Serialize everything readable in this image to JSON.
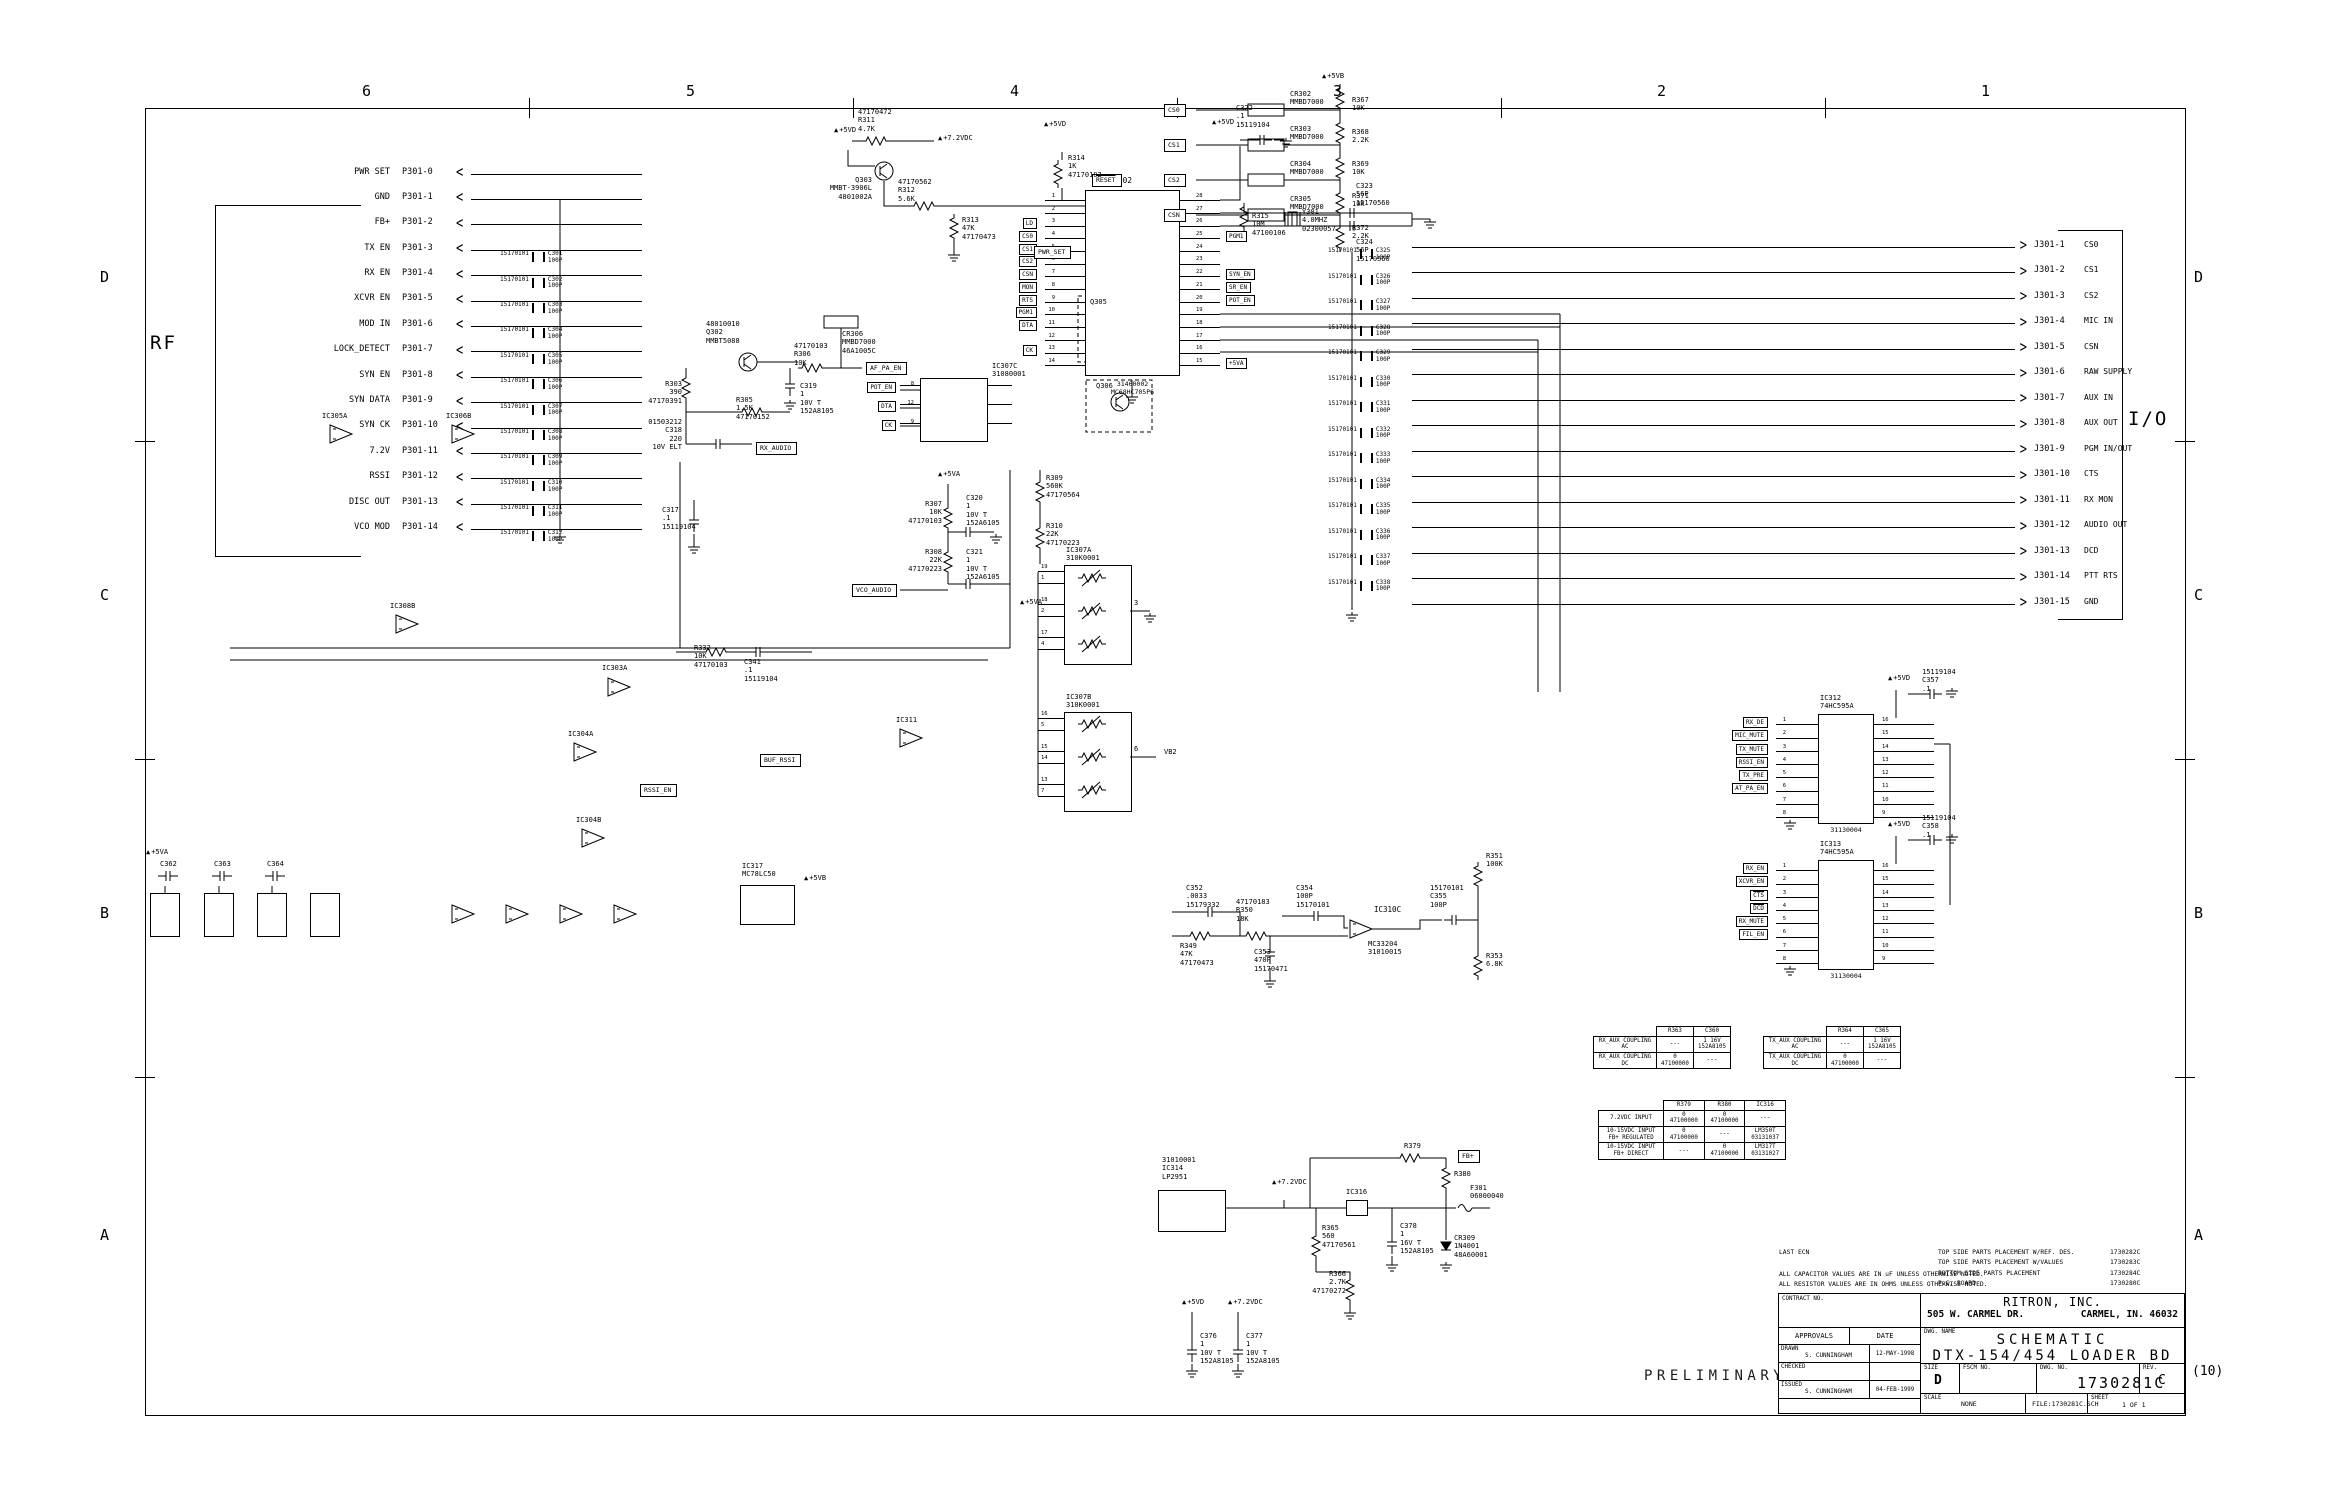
{
  "frame": {
    "cols": [
      "6",
      "5",
      "4",
      "3",
      "2",
      "1"
    ],
    "rows": [
      "D",
      "C",
      "B",
      "A"
    ],
    "rev_suffix": "(10)"
  },
  "sections": {
    "rf": "RF",
    "io": "I/O",
    "preliminary": "PRELIMINARY"
  },
  "rf": {
    "pins": [
      {
        "signal": "PWR SET",
        "pin": "P301-0",
        "cap": "",
        "cap_pn": "",
        "cap_txt": ""
      },
      {
        "signal": "GND",
        "pin": "P301-1",
        "cap": "",
        "cap_pn": "",
        "cap_txt": ""
      },
      {
        "signal": "FB+",
        "pin": "P301-2",
        "cap": "",
        "cap_pn": "",
        "cap_txt": ""
      },
      {
        "signal": "TX EN",
        "pin": "P301-3",
        "cap": "C301",
        "cap_pn": "15170101",
        "cap_txt": "C301\n100P"
      },
      {
        "signal": "RX EN",
        "pin": "P301-4",
        "cap": "C302",
        "cap_pn": "15170101",
        "cap_txt": "C302\n100P"
      },
      {
        "signal": "XCVR EN",
        "pin": "P301-5",
        "cap": "C303",
        "cap_pn": "15170101",
        "cap_txt": "C303\n100P"
      },
      {
        "signal": "MOD IN",
        "pin": "P301-6",
        "cap": "C304",
        "cap_pn": "15170101",
        "cap_txt": "C304\n100P"
      },
      {
        "signal": "LOCK_DETECT",
        "pin": "P301-7",
        "cap": "C305",
        "cap_pn": "15170101",
        "cap_txt": "C305\n100P"
      },
      {
        "signal": "SYN EN",
        "pin": "P301-8",
        "cap": "C306",
        "cap_pn": "15170101",
        "cap_txt": "C306\n100P"
      },
      {
        "signal": "SYN DATA",
        "pin": "P301-9",
        "cap": "C307",
        "cap_pn": "15170101",
        "cap_txt": "C307\n100P"
      },
      {
        "signal": "SYN CK",
        "pin": "P301-10",
        "cap": "C308",
        "cap_pn": "15170101",
        "cap_txt": "C308\n100P"
      },
      {
        "signal": "7.2V",
        "pin": "P301-11",
        "cap": "C309",
        "cap_pn": "15170101",
        "cap_txt": "C309\n100P"
      },
      {
        "signal": "RSSI",
        "pin": "P301-12",
        "cap": "C310",
        "cap_pn": "15170101",
        "cap_txt": "C310\n100P"
      },
      {
        "signal": "DISC OUT",
        "pin": "P301-13",
        "cap": "C311",
        "cap_pn": "15170101",
        "cap_txt": "C311\n100P"
      },
      {
        "signal": "VCO MOD",
        "pin": "P301-14",
        "cap": "C312",
        "cap_pn": "15170101",
        "cap_txt": "C312\n100P"
      }
    ]
  },
  "io": {
    "pins": [
      {
        "pin": "J301-1",
        "signal": "CS0",
        "cap": "C325",
        "cap_pn": "15170101",
        "cap_txt": "C325\n100P"
      },
      {
        "pin": "J301-2",
        "signal": "CS1",
        "cap": "C326",
        "cap_pn": "15170101",
        "cap_txt": "C326\n100P"
      },
      {
        "pin": "J301-3",
        "signal": "CS2",
        "cap": "C327",
        "cap_pn": "15170101",
        "cap_txt": "C327\n100P"
      },
      {
        "pin": "J301-4",
        "signal": "MIC IN",
        "cap": "C328",
        "cap_pn": "15170101",
        "cap_txt": "C328\n100P"
      },
      {
        "pin": "J301-5",
        "signal": "CSN",
        "cap": "C329",
        "cap_pn": "15170101",
        "cap_txt": "C329\n100P"
      },
      {
        "pin": "J301-6",
        "signal": "RAW SUPPLY",
        "cap": "C330",
        "cap_pn": "15170101",
        "cap_txt": "C330\n100P"
      },
      {
        "pin": "J301-7",
        "signal": "AUX IN",
        "cap": "C331",
        "cap_pn": "15170101",
        "cap_txt": "C331\n100P"
      },
      {
        "pin": "J301-8",
        "signal": "AUX OUT",
        "cap": "C332",
        "cap_pn": "15170101",
        "cap_txt": "C332\n100P"
      },
      {
        "pin": "J301-9",
        "signal": "PGM IN/OUT",
        "cap": "C333",
        "cap_pn": "15170101",
        "cap_txt": "C333\n100P"
      },
      {
        "pin": "J301-10",
        "signal": "CTS",
        "cap": "C334",
        "cap_pn": "15170101",
        "cap_txt": "C334\n100P"
      },
      {
        "pin": "J301-11",
        "signal": "RX MON",
        "cap": "C335",
        "cap_pn": "15170101",
        "cap_txt": "C335\n100P"
      },
      {
        "pin": "J301-12",
        "signal": "AUDIO OUT",
        "cap": "C336",
        "cap_pn": "15170101",
        "cap_txt": "C336\n100P"
      },
      {
        "pin": "J301-13",
        "signal": "DCD",
        "cap": "C337",
        "cap_pn": "15170101",
        "cap_txt": "C337\n100P"
      },
      {
        "pin": "J301-14",
        "signal": "PTT RTS",
        "cap": "C338",
        "cap_pn": "15170101",
        "cap_txt": "C338\n100P"
      },
      {
        "pin": "J301-15",
        "signal": "GND",
        "cap": "",
        "cap_pn": "",
        "cap_txt": ""
      }
    ]
  },
  "mcu": {
    "ref": "IC302",
    "pn": "31460002\nMC68HC705P6",
    "left": [
      {
        "n": "1",
        "name": "RESET",
        "flag": ""
      },
      {
        "n": "2",
        "name": "IRQ",
        "flag": ""
      },
      {
        "n": "3",
        "name": "PA7",
        "flag": "LD"
      },
      {
        "n": "4",
        "name": "PA6",
        "flag": "CS0"
      },
      {
        "n": "5",
        "name": "PA5",
        "flag": "CS1"
      },
      {
        "n": "6",
        "name": "PA4",
        "flag": "CS2"
      },
      {
        "n": "7",
        "name": "PA3",
        "flag": "CSN"
      },
      {
        "n": "8",
        "name": "PA2",
        "flag": "MON"
      },
      {
        "n": "9",
        "name": "PA1",
        "flag": "RTS"
      },
      {
        "n": "10",
        "name": "PA0",
        "flag": "PGM1"
      },
      {
        "n": "11",
        "name": "PB5/SDO",
        "flag": "DTA"
      },
      {
        "n": "12",
        "name": "PB6/SDI",
        "flag": ""
      },
      {
        "n": "13",
        "name": "PB7/SCK",
        "flag": "CK"
      },
      {
        "n": "14",
        "name": "VSS",
        "flag": ""
      }
    ],
    "right": [
      {
        "n": "28",
        "name": "VDD",
        "flag": ""
      },
      {
        "n": "27",
        "name": "OSC1",
        "flag": ""
      },
      {
        "n": "26",
        "name": "OSC2",
        "flag": ""
      },
      {
        "n": "25",
        "name": "PD7/TCAP",
        "flag": "PGM1"
      },
      {
        "n": "24",
        "name": "TCMP",
        "flag": ""
      },
      {
        "n": "23",
        "name": "PD5",
        "flag": ""
      },
      {
        "n": "22",
        "name": "PC0",
        "flag": "SYN_EN"
      },
      {
        "n": "21",
        "name": "PC1",
        "flag": "SR_EN"
      },
      {
        "n": "20",
        "name": "PC2",
        "flag": "POT_EN"
      },
      {
        "n": "19",
        "name": "PC3/AN3",
        "flag": ""
      },
      {
        "n": "18",
        "name": "PC4/AN2",
        "flag": ""
      },
      {
        "n": "17",
        "name": "PC5/AN1",
        "flag": ""
      },
      {
        "n": "16",
        "name": "PC6/AN0",
        "flag": ""
      },
      {
        "n": "15",
        "name": "PC7/VRH",
        "flag": "+5VA"
      }
    ]
  },
  "pots": {
    "a_ref": "IC307A\n310K0001",
    "b_ref": "IC307B\n310K0001",
    "a_rows": [
      {
        "n1": "19",
        "n2": "1",
        "label": "BALANCE"
      },
      {
        "n1": "18",
        "n2": "2",
        "label": "TX FREQ"
      },
      {
        "n1": "17",
        "n2": "4",
        "label": "RX AUDIO GAIN"
      }
    ],
    "b_rows": [
      {
        "n1": "16",
        "n2": "5",
        "label": "AUX RX GAIN"
      },
      {
        "n1": "15",
        "n2": "14",
        "label": "AUX TX GAIN"
      },
      {
        "n1": "13",
        "n2": "7",
        "label": "DEVIATION"
      }
    ],
    "a_com": "3",
    "b_com": "6",
    "b_net": "VB2",
    "c_ref": "IC307C\n31080001",
    "c_left": [
      {
        "n": "8",
        "name": "RST",
        "flag": "POT_EN"
      },
      {
        "n": "12",
        "name": "DATA IN",
        "flag": "DTA"
      },
      {
        "n": "9",
        "name": "CLK",
        "flag": "CK"
      }
    ],
    "c_right": [
      {
        "name": "VCC"
      },
      {
        "name": "D OUT"
      },
      {
        "name": "GND"
      }
    ]
  },
  "sr1": {
    "ref": "IC312\n74HC595A",
    "pn": "31130004",
    "cap": "15119104\nC357\n.1",
    "left": [
      {
        "n": "1",
        "name": "QB",
        "flag": "RX_DE"
      },
      {
        "n": "2",
        "name": "QC",
        "flag": "MIC_MUTE"
      },
      {
        "n": "3",
        "name": "QD",
        "flag": "TX_MUTE"
      },
      {
        "n": "4",
        "name": "QE",
        "flag": "RSSI_EN"
      },
      {
        "n": "5",
        "name": "QF",
        "flag": "TX_PRE"
      },
      {
        "n": "6",
        "name": "QG",
        "flag": "AT_PA_EN"
      },
      {
        "n": "7",
        "name": "QH",
        "flag": ""
      },
      {
        "n": "8",
        "name": "GND",
        "flag": ""
      }
    ],
    "right": [
      {
        "n": "16",
        "name": "VCC"
      },
      {
        "n": "15",
        "name": "QA"
      },
      {
        "n": "14",
        "name": "A"
      },
      {
        "n": "13",
        "name": "OE"
      },
      {
        "n": "12",
        "name": "LC"
      },
      {
        "n": "11",
        "name": "SC"
      },
      {
        "n": "10",
        "name": "RST"
      },
      {
        "n": "9",
        "name": "SQH"
      }
    ]
  },
  "sr2": {
    "ref": "IC313\n74HC595A",
    "pn": "31130004",
    "cap": "15119104\nC358\n.1",
    "left": [
      {
        "n": "1",
        "name": "QB",
        "flag": "RX_EN"
      },
      {
        "n": "2",
        "name": "QC",
        "flag": "XCVR_EN"
      },
      {
        "n": "3",
        "name": "QD",
        "flag": "CTS"
      },
      {
        "n": "4",
        "name": "QE",
        "flag": "DCD"
      },
      {
        "n": "5",
        "name": "QF",
        "flag": "RX_MUTE"
      },
      {
        "n": "6",
        "name": "QG",
        "flag": "FIL_EN"
      },
      {
        "n": "7",
        "name": "QH",
        "flag": ""
      },
      {
        "n": "8",
        "name": "GND",
        "flag": ""
      }
    ],
    "right": [
      {
        "n": "16",
        "name": "VCC"
      },
      {
        "n": "15",
        "name": "QA"
      },
      {
        "n": "14",
        "name": "A"
      },
      {
        "n": "13",
        "name": "OE"
      },
      {
        "n": "12",
        "name": "LC"
      },
      {
        "n": "11",
        "name": "SC"
      },
      {
        "n": "10",
        "name": "RST"
      },
      {
        "n": "9",
        "name": "SQH"
      }
    ]
  },
  "tables": {
    "t1": {
      "h": [
        "R363",
        "C360"
      ],
      "rows": [
        [
          "RX_AUX COUPLING\nAC",
          "---",
          "1 16V\n152A8105"
        ],
        [
          "RX_AUX COUPLING\nDC",
          "0\n47100000",
          "---"
        ]
      ]
    },
    "t2": {
      "h": [
        "R364",
        "C365"
      ],
      "rows": [
        [
          "TX_AUX COUPLING\nAC",
          "---",
          "1 16V\n152A8105"
        ],
        [
          "TX_AUX COUPLING\nDC",
          "0\n47100000",
          "---"
        ]
      ]
    },
    "t3": {
      "h": [
        "R379",
        "R380",
        "IC316"
      ],
      "rows": [
        [
          "7.2VDC INPUT",
          "0\n47100000",
          "0\n47100000",
          "---"
        ],
        [
          "10-15VDC INPUT\nFB+ REGULATED",
          "0\n47100000",
          "---",
          "LM350T\n03131037"
        ],
        [
          "10-15VDC INPUT\nFB+ DIRECT",
          "---",
          "0\n47100000",
          "LM317T\n03131027"
        ]
      ]
    }
  },
  "notes": {
    "last_ecn": "LAST ECN",
    "cap_note": "ALL CAPACITOR VALUES ARE IN uF UNLESS OTHERWISE NOTED.",
    "res_note": "ALL RESISTOR VALUES ARE IN OHMS UNLESS OTHERWISE NOTED.",
    "refs": [
      {
        "label": "TOP SIDE PARTS PLACEMENT W/REF. DES.",
        "num": "1730282C"
      },
      {
        "label": "TOP SIDE PARTS PLACEMENT W/VALUES",
        "num": "1730283C"
      },
      {
        "label": "BOTTOM SIDE PARTS PLACEMENT",
        "num": "1730284C"
      },
      {
        "label": "P.C. BOARD",
        "num": "1730280C"
      }
    ]
  },
  "title": {
    "contract_label": "CONTRACT NO.",
    "approvals": "APPROVALS",
    "date": "DATE",
    "drawn_label": "DRAWN",
    "drawn_by": "S. CUNNINGHAM",
    "drawn_date": "12-MAY-1998",
    "checked_label": "CHECKED",
    "issued_label": "ISSUED",
    "issued_by": "S. CUNNINGHAM",
    "issued_date": "04-FEB-1999",
    "company": "RITRON, INC.",
    "addr1": "505 W. CARMEL DR.",
    "addr2": "CARMEL, IN. 46032",
    "dwg_name_label": "DWG. NAME",
    "name1": "SCHEMATIC",
    "name2": "DTX-154/454 LOADER BD",
    "size_label": "SIZE",
    "size": "D",
    "fscm_label": "FSCM NO.",
    "dwgno_label": "DWG. NO.",
    "dwgno": "1730281C",
    "rev_label": "REV.",
    "rev": "C",
    "scale_label": "SCALE",
    "scale": "NONE",
    "file": "FILE:1730281C.SCH",
    "sheet_label": "SHEET",
    "sheet": "1  OF  1"
  },
  "misc": [
    "+5VD",
    "47170472\nR311\n4.7K",
    "+7.2VDC",
    "Q303\nMMBT-3906L\n4801002A",
    "47170562\nR312\n5.6K",
    "R313\n47K\n47170473",
    "RESET",
    "R314\n1K\n47170102",
    "C322\n.1\n15119104",
    "+5VD",
    "R315\n10M\n47100106",
    "Y301\n4.0MHZ\n02300057",
    "C323\n56P\n15170560",
    "C324\n56P\n15170560",
    "48010010\nQ302\nMMBT5088",
    "CR306\nMMBD7000\n46A1005C",
    "47170103\nR306\n10K",
    "AF_PA_EN",
    "C319\n1\n10V T\n152A8105",
    "R303\n390\n47170391",
    "R305\n1.5K\n47170152",
    "01503212\nC318\n220\n10V ELT",
    "RX_AUDIO",
    "C317\n.1\n15119104",
    "+5VA",
    "R307\n10K\n47170103",
    "C320\n1\n10V T\n152A6105",
    "R308\n22K\n47170223",
    "C321\n1\n10V T\n152A6105",
    "VCO_AUDIO",
    "R309\n560K\n47170564",
    "R310\n22K\n47170223",
    "R332\n10K\n47170103",
    "C341\n.1\n15119104",
    "C352\n.0033\n15179332",
    "R349\n47K\n47170473",
    "47170183\nR350\n18K",
    "C353\n470P\n15170471",
    "C354\n100P\n15170101",
    "IC310C",
    "MC33204\n31010015",
    "15170101\nC355\n100P",
    "R351\n100K",
    "R353\n6.8K",
    "31010001\nIC314\nLP2951",
    "+7.2VDC",
    "R365\n560\n47170561",
    "IC316",
    "C378\n1\n16V T\n152A8105",
    "R366\n2.7K\n47170272",
    "R379",
    "FB+",
    "R380",
    "F301\n06000040",
    "CR309\n1N4001\n48A60001",
    "+5VD",
    "+7.2VDC",
    "C376\n1\n10V T\n152A8105",
    "C377\n1\n10V T\n152A8105",
    "IC317\nMC78LC50",
    "+5VB",
    "IC305A",
    "IC306B",
    "IC308B",
    "IC303A",
    "IC304A",
    "IC304B",
    "IC311",
    "CR302\nMMBD7000",
    "CR303\nMMBD7000",
    "CR304\nMMBD7000",
    "CR305\nMMBD7000",
    "R367\n10K",
    "R368\n2.2K",
    "R369\n10K",
    "R371\n10K",
    "R372\n2.2K",
    "+5VB",
    "CS0",
    "CS1",
    "CS2",
    "CSN",
    "Q305",
    "Q306",
    "C362",
    "C363",
    "C364",
    "+5VA",
    "PWR_SET",
    "BUF_RSSI",
    "RSSI_EN",
    "VB2",
    "+5VA",
    "+5VD"
  ]
}
